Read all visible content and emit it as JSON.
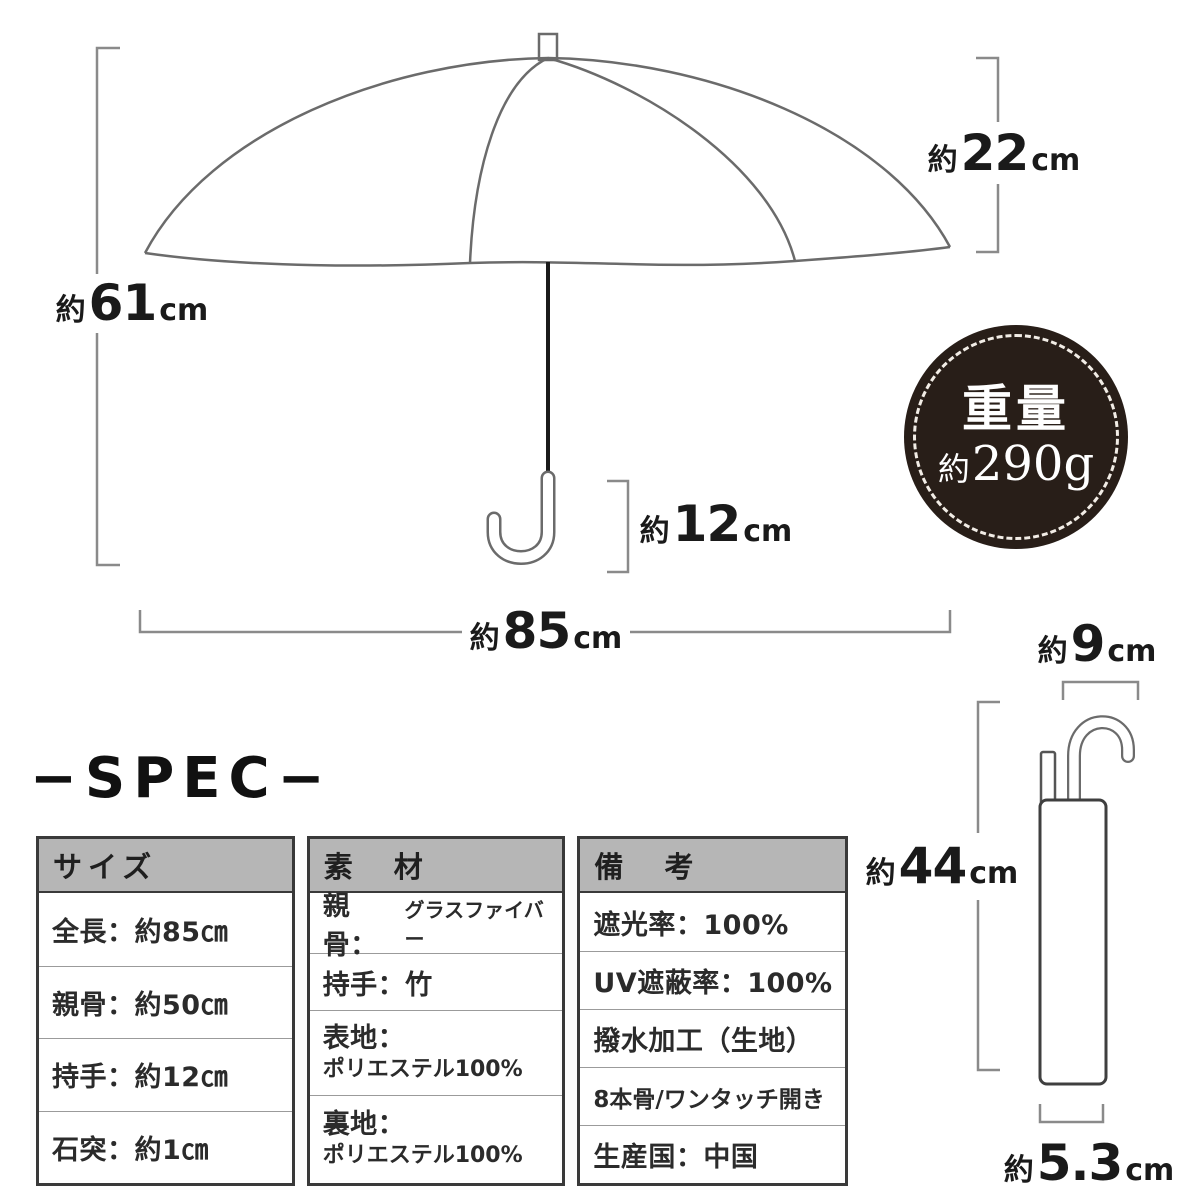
{
  "diagram": {
    "dimensions": {
      "canopy_depth": {
        "approx": "約",
        "value": "22",
        "unit": "cm"
      },
      "total_height": {
        "approx": "約",
        "value": "61",
        "unit": "cm"
      },
      "handle_length": {
        "approx": "約",
        "value": "12",
        "unit": "cm"
      },
      "open_width": {
        "approx": "約",
        "value": "85",
        "unit": "cm"
      },
      "folded_hook_width": {
        "approx": "約",
        "value": "9",
        "unit": "cm"
      },
      "folded_height": {
        "approx": "約",
        "value": "44",
        "unit": "cm"
      },
      "folded_width": {
        "approx": "約",
        "value": "5.3",
        "unit": "cm"
      }
    },
    "weight_badge": {
      "title": "重量",
      "approx": "約",
      "value": "290g"
    }
  },
  "spec": {
    "heading": "−SPEC−",
    "table": {
      "size": {
        "header": "サイズ",
        "rows": [
          "全長：約85㎝",
          "親骨：約50㎝",
          "持手：約12㎝",
          "石突：約1㎝"
        ]
      },
      "material": {
        "header": "素　材",
        "row1_label": "親骨：",
        "row1_value": "グラスファイバー",
        "row2": "持手：竹",
        "row3_label": "表地：",
        "row3_value": "ポリエステル100%",
        "row4_label": "裏地：",
        "row4_value": "ポリエステル100%"
      },
      "notes": {
        "header": "備　考",
        "rows": [
          "遮光率：100%",
          "UV遮蔽率：100%",
          "撥水加工（生地）",
          "8本骨/ワンタッチ開き",
          "生産国：中国"
        ]
      }
    }
  },
  "colors": {
    "badge_bg": "#281e18",
    "table_header_bg": "#b6b6b6",
    "line_gray": "#6b6b6b",
    "text": "#1a1a1a"
  }
}
